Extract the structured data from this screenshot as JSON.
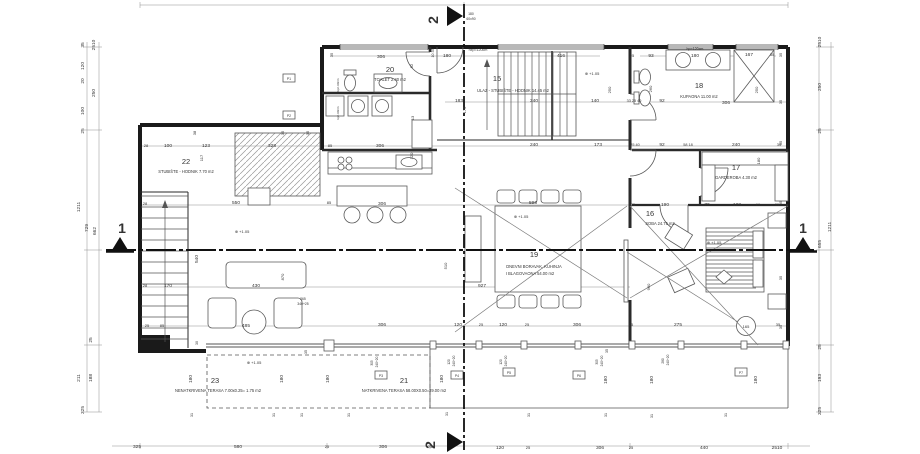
{
  "drawing": {
    "title": "Floor plan - first floor",
    "colors": {
      "wall": "#1a1a1a",
      "line": "#555555",
      "dim": "#8f8f8f",
      "text": "#333333",
      "bg": "#ffffff"
    }
  },
  "rooms": [
    {
      "num": "22",
      "name": "STUBIŠTE - HODNIK 7.70 m2",
      "nx": 186,
      "ny": 164,
      "lx": 186,
      "ly": 173
    },
    {
      "num": "20",
      "name": "TOALET 2.40 m2",
      "nx": 390,
      "ny": 72,
      "lx": 390,
      "ly": 81
    },
    {
      "num": "15",
      "name": "ULAZ - STUBIŠTE - HODNIK 14.45 m2",
      "nx": 497,
      "ny": 81,
      "lx": 513,
      "ly": 92
    },
    {
      "num": "18",
      "name": "KUPAONA 11.00 m2",
      "nx": 699,
      "ny": 88,
      "lx": 699,
      "ly": 98
    },
    {
      "num": "17",
      "name": "GARDEROBA 4.30 m2",
      "nx": 736,
      "ny": 170,
      "lx": 736,
      "ly": 179
    },
    {
      "num": "16",
      "name": "SOBA 24.75 m2",
      "nx": 650,
      "ny": 216,
      "lx": 660,
      "ly": 225
    },
    {
      "num": "19",
      "name": "DNEVNI BORAVAK, KUHINJA",
      "name2": "I BLAGOVAONA 54.00 m2",
      "nx": 534,
      "ny": 257,
      "lx": 534,
      "ly": 268,
      "l2x": 530,
      "l2y": 275
    },
    {
      "num": "23",
      "name": "NENATKRIVENA TERASA 7.00x0.25= 1.75 m2",
      "nx": 215,
      "ny": 383,
      "lx": 218,
      "ly": 392
    },
    {
      "num": "21",
      "name": "NATKRIVENA TERASA 58.00X0.50=29.00 m2",
      "nx": 404,
      "ny": 383,
      "lx": 404,
      "ly": 392
    }
  ],
  "sections": [
    {
      "label": "1",
      "x": 122,
      "y": 233
    },
    {
      "label": "1",
      "x": 803,
      "y": 233
    },
    {
      "label": "2",
      "x": 438,
      "y": 20,
      "r": -90
    },
    {
      "label": "2",
      "x": 435,
      "y": 445,
      "r": -90
    }
  ],
  "dims": [
    {
      "t": "35",
      "x": 84,
      "y": 45,
      "r": -90
    },
    {
      "t": "2510",
      "x": 95,
      "y": 45,
      "r": -90
    },
    {
      "t": "120",
      "x": 84,
      "y": 66,
      "r": -90
    },
    {
      "t": "20",
      "x": 84,
      "y": 81,
      "r": -90
    },
    {
      "t": "250",
      "x": 95,
      "y": 93,
      "r": -90
    },
    {
      "t": "100",
      "x": 84,
      "y": 111,
      "r": -90
    },
    {
      "t": "25",
      "x": 84,
      "y": 131,
      "r": -90
    },
    {
      "t": "1211",
      "x": 80,
      "y": 207,
      "r": -90
    },
    {
      "t": "729",
      "x": 88,
      "y": 228,
      "r": -90
    },
    {
      "t": "662",
      "x": 96,
      "y": 231,
      "r": -90
    },
    {
      "t": "25",
      "x": 92,
      "y": 340,
      "r": -90
    },
    {
      "t": "211",
      "x": 80,
      "y": 378,
      "r": -90
    },
    {
      "t": "188",
      "x": 92,
      "y": 378,
      "r": -90
    },
    {
      "t": "325",
      "x": 84,
      "y": 410,
      "r": -90
    },
    {
      "t": "2510",
      "x": 821,
      "y": 42,
      "r": -90
    },
    {
      "t": "250",
      "x": 821,
      "y": 87,
      "r": -90
    },
    {
      "t": "25",
      "x": 821,
      "y": 131,
      "r": -90
    },
    {
      "t": "1211",
      "x": 831,
      "y": 227,
      "r": -90
    },
    {
      "t": "655",
      "x": 821,
      "y": 244,
      "r": -90
    },
    {
      "t": "25",
      "x": 821,
      "y": 347,
      "r": -90
    },
    {
      "t": "193",
      "x": 821,
      "y": 378,
      "r": -90
    },
    {
      "t": "325",
      "x": 821,
      "y": 411,
      "r": -90
    },
    {
      "t": "35",
      "x": 782,
      "y": 55,
      "r": -90,
      "s": 4
    },
    {
      "t": "35",
      "x": 782,
      "y": 102,
      "r": -90,
      "s": 4
    },
    {
      "t": "35",
      "x": 782,
      "y": 143,
      "r": -90,
      "s": 4
    },
    {
      "t": "35",
      "x": 782,
      "y": 203,
      "r": -90,
      "s": 4
    },
    {
      "t": "35",
      "x": 782,
      "y": 278,
      "r": -90,
      "s": 4
    },
    {
      "t": "35",
      "x": 782,
      "y": 327,
      "r": -90,
      "s": 4
    },
    {
      "t": "306",
      "x": 381,
      "y": 58
    },
    {
      "t": "180",
      "x": 447,
      "y": 57
    },
    {
      "t": "hxp=120cm",
      "x": 478,
      "y": 51,
      "s": 3.6
    },
    {
      "t": "416",
      "x": 561,
      "y": 57
    },
    {
      "t": "25",
      "x": 632,
      "y": 57,
      "s": 4
    },
    {
      "t": "93",
      "x": 651,
      "y": 57
    },
    {
      "t": "180",
      "x": 695,
      "y": 57
    },
    {
      "t": "hp=120cm",
      "x": 695,
      "y": 50,
      "s": 3.6
    },
    {
      "t": "167",
      "x": 749,
      "y": 56
    },
    {
      "t": "35",
      "x": 772,
      "y": 56,
      "s": 4
    },
    {
      "t": "35",
      "x": 333,
      "y": 55,
      "r": -90,
      "s": 4
    },
    {
      "t": "10 35",
      "x": 434,
      "y": 53,
      "r": -90,
      "s": 3.6
    },
    {
      "t": "180",
      "x": 471,
      "y": 15,
      "s": 3.4
    },
    {
      "t": "60x90",
      "x": 471,
      "y": 20,
      "s": 3.4
    },
    {
      "t": "⊕ +1.05",
      "x": 592,
      "y": 75,
      "s": 4
    },
    {
      "t": "250",
      "x": 611,
      "y": 90,
      "r": -90,
      "s": 4
    },
    {
      "t": "260",
      "x": 652,
      "y": 89,
      "r": -90,
      "s": 4
    },
    {
      "t": "250",
      "x": 758,
      "y": 90,
      "r": -90,
      "s": 4
    },
    {
      "t": "92",
      "x": 413,
      "y": 66,
      "r": -90,
      "s": 4
    },
    {
      "t": "183",
      "x": 459,
      "y": 102
    },
    {
      "t": "240",
      "x": 534,
      "y": 102
    },
    {
      "t": "140",
      "x": 595,
      "y": 102
    },
    {
      "t": "33 25 40",
      "x": 634,
      "y": 102,
      "s": 3.8
    },
    {
      "t": "92",
      "x": 662,
      "y": 102
    },
    {
      "t": "306",
      "x": 726,
      "y": 104
    },
    {
      "t": "13",
      "x": 414,
      "y": 118,
      "r": -90,
      "s": 4
    },
    {
      "t": "175",
      "x": 466,
      "y": 110,
      "r": -90,
      "s": 4
    },
    {
      "t": "120",
      "x": 413,
      "y": 156,
      "r": -90,
      "s": 4
    },
    {
      "t": "28",
      "x": 146,
      "y": 147,
      "s": 4
    },
    {
      "t": "100",
      "x": 168,
      "y": 147
    },
    {
      "t": "123",
      "x": 206,
      "y": 147
    },
    {
      "t": "38",
      "x": 196,
      "y": 133,
      "r": -90,
      "s": 4
    },
    {
      "t": "117",
      "x": 203,
      "y": 158,
      "r": -90,
      "s": 4
    },
    {
      "t": "328",
      "x": 272,
      "y": 147
    },
    {
      "t": "35",
      "x": 284,
      "y": 133,
      "r": -90,
      "s": 4
    },
    {
      "t": "35",
      "x": 309,
      "y": 133,
      "r": -90,
      "s": 4
    },
    {
      "t": "85",
      "x": 330,
      "y": 147,
      "s": 4
    },
    {
      "t": "306",
      "x": 380,
      "y": 147
    },
    {
      "t": "240",
      "x": 534,
      "y": 146
    },
    {
      "t": "173",
      "x": 598,
      "y": 146
    },
    {
      "t": "25 40",
      "x": 635,
      "y": 146,
      "s": 3.8
    },
    {
      "t": "92",
      "x": 662,
      "y": 146
    },
    {
      "t": "58 18",
      "x": 688,
      "y": 146,
      "s": 3.8
    },
    {
      "t": "240",
      "x": 736,
      "y": 146
    },
    {
      "t": "35",
      "x": 779,
      "y": 146,
      "s": 4
    },
    {
      "t": "180",
      "x": 760,
      "y": 161,
      "r": -90,
      "s": 4
    },
    {
      "t": "25",
      "x": 633,
      "y": 206,
      "s": 4
    },
    {
      "t": "190",
      "x": 665,
      "y": 206
    },
    {
      "t": "70",
      "x": 707,
      "y": 206
    },
    {
      "t": "128",
      "x": 737,
      "y": 206
    },
    {
      "t": "60",
      "x": 758,
      "y": 206,
      "s": 4
    },
    {
      "t": "35",
      "x": 777,
      "y": 206,
      "s": 4
    },
    {
      "t": "⊕ +1.05",
      "x": 714,
      "y": 244,
      "s": 4
    },
    {
      "t": "540",
      "x": 198,
      "y": 259,
      "r": -90
    },
    {
      "t": "550",
      "x": 236,
      "y": 204
    },
    {
      "t": "85",
      "x": 329,
      "y": 204,
      "s": 4
    },
    {
      "t": "306",
      "x": 382,
      "y": 205
    },
    {
      "t": "596",
      "x": 533,
      "y": 204
    },
    {
      "t": "⊕ +1.05",
      "x": 242,
      "y": 233,
      "s": 4
    },
    {
      "t": "⊕ +1.05",
      "x": 521,
      "y": 218,
      "s": 4
    },
    {
      "t": "28",
      "x": 145,
      "y": 205,
      "s": 4
    },
    {
      "t": "28",
      "x": 145,
      "y": 287,
      "s": 4
    },
    {
      "t": "170",
      "x": 168,
      "y": 287
    },
    {
      "t": "430",
      "x": 256,
      "y": 287
    },
    {
      "t": "870",
      "x": 284,
      "y": 277,
      "r": -90,
      "s": 4
    },
    {
      "t": "510",
      "x": 447,
      "y": 266,
      "r": -90,
      "s": 4
    },
    {
      "t": "927",
      "x": 482,
      "y": 287
    },
    {
      "t": "960",
      "x": 650,
      "y": 287,
      "r": -90,
      "s": 4
    },
    {
      "t": "265",
      "x": 303,
      "y": 300,
      "s": 3.4
    },
    {
      "t": "340+25",
      "x": 303,
      "y": 305,
      "s": 3.4
    },
    {
      "t": "25",
      "x": 147,
      "y": 327,
      "s": 4
    },
    {
      "t": "85",
      "x": 162,
      "y": 327,
      "s": 4
    },
    {
      "t": "485",
      "x": 246,
      "y": 327
    },
    {
      "t": "306",
      "x": 382,
      "y": 326
    },
    {
      "t": "120",
      "x": 458,
      "y": 326
    },
    {
      "t": "25",
      "x": 481,
      "y": 326,
      "s": 4
    },
    {
      "t": "120",
      "x": 503,
      "y": 326
    },
    {
      "t": "25",
      "x": 527,
      "y": 326,
      "s": 4
    },
    {
      "t": "306",
      "x": 577,
      "y": 326
    },
    {
      "t": "25",
      "x": 631,
      "y": 326,
      "s": 4
    },
    {
      "t": "275",
      "x": 678,
      "y": 326
    },
    {
      "t": "165",
      "x": 746,
      "y": 328,
      "s": 4
    },
    {
      "t": "35",
      "x": 778,
      "y": 326,
      "s": 4
    },
    {
      "t": "30",
      "x": 198,
      "y": 343,
      "r": -90,
      "s": 3.6
    },
    {
      "t": "35",
      "x": 307,
      "y": 352,
      "r": -90,
      "s": 3.6
    },
    {
      "t": "35",
      "x": 608,
      "y": 351,
      "r": -90,
      "s": 3.6
    },
    {
      "t": "⊕ +1.05",
      "x": 254,
      "y": 364,
      "s": 4
    },
    {
      "t": "305",
      "x": 373,
      "y": 363,
      "r": -90,
      "s": 3.2
    },
    {
      "t": "240+20",
      "x": 378,
      "y": 362,
      "r": -90,
      "s": 3.2
    },
    {
      "t": "120",
      "x": 450,
      "y": 362,
      "r": -90,
      "s": 3.2
    },
    {
      "t": "240+20",
      "x": 455,
      "y": 361,
      "r": -90,
      "s": 3.2
    },
    {
      "t": "120",
      "x": 502,
      "y": 362,
      "r": -90,
      "s": 3.2
    },
    {
      "t": "240+20",
      "x": 507,
      "y": 361,
      "r": -90,
      "s": 3.2
    },
    {
      "t": "305",
      "x": 598,
      "y": 362,
      "r": -90,
      "s": 3.2
    },
    {
      "t": "240+20",
      "x": 603,
      "y": 361,
      "r": -90,
      "s": 3.2
    },
    {
      "t": "280",
      "x": 664,
      "y": 361,
      "r": -90,
      "s": 3.2
    },
    {
      "t": "240+20",
      "x": 669,
      "y": 360,
      "r": -90,
      "s": 3.2
    },
    {
      "t": "180",
      "x": 192,
      "y": 379,
      "r": -90
    },
    {
      "t": "180",
      "x": 283,
      "y": 379,
      "r": -90
    },
    {
      "t": "180",
      "x": 329,
      "y": 379,
      "r": -90
    },
    {
      "t": "180",
      "x": 443,
      "y": 379,
      "r": -90
    },
    {
      "t": "180",
      "x": 607,
      "y": 380,
      "r": -90
    },
    {
      "t": "180",
      "x": 653,
      "y": 380,
      "r": -90
    },
    {
      "t": "180",
      "x": 757,
      "y": 380,
      "r": -90
    },
    {
      "t": "31",
      "x": 193,
      "y": 415,
      "r": -90,
      "s": 3.6
    },
    {
      "t": "31",
      "x": 275,
      "y": 415,
      "r": -90,
      "s": 3.6
    },
    {
      "t": "31",
      "x": 303,
      "y": 415,
      "r": -90,
      "s": 3.6
    },
    {
      "t": "31",
      "x": 350,
      "y": 415,
      "r": -90,
      "s": 3.6
    },
    {
      "t": "31",
      "x": 448,
      "y": 414,
      "r": -90,
      "s": 3.6
    },
    {
      "t": "31",
      "x": 530,
      "y": 415,
      "r": -90,
      "s": 3.6
    },
    {
      "t": "31",
      "x": 607,
      "y": 415,
      "r": -90,
      "s": 3.6
    },
    {
      "t": "31",
      "x": 653,
      "y": 416,
      "r": -90,
      "s": 3.6
    },
    {
      "t": "31",
      "x": 727,
      "y": 415,
      "r": -90,
      "s": 3.6
    },
    {
      "t": "325",
      "x": 137,
      "y": 448
    },
    {
      "t": "580",
      "x": 238,
      "y": 448
    },
    {
      "t": "25",
      "x": 327,
      "y": 448,
      "s": 4
    },
    {
      "t": "306",
      "x": 383,
      "y": 448
    },
    {
      "t": "25",
      "x": 430,
      "y": 448,
      "s": 4
    },
    {
      "t": "120",
      "x": 500,
      "y": 449
    },
    {
      "t": "25",
      "x": 528,
      "y": 449,
      "s": 4
    },
    {
      "t": "306",
      "x": 600,
      "y": 449
    },
    {
      "t": "25",
      "x": 631,
      "y": 449,
      "s": 4
    },
    {
      "t": "440",
      "x": 704,
      "y": 449
    },
    {
      "t": "2510",
      "x": 777,
      "y": 449
    },
    {
      "t": "P1",
      "x": 289,
      "y": 80,
      "s": 3.4
    },
    {
      "t": "P2",
      "x": 289,
      "y": 117,
      "s": 3.4
    },
    {
      "t": "P3",
      "x": 381,
      "y": 377,
      "s": 3.4
    },
    {
      "t": "P4",
      "x": 457,
      "y": 377,
      "s": 3.4
    },
    {
      "t": "P5",
      "x": 509,
      "y": 374,
      "s": 3.4
    },
    {
      "t": "P6",
      "x": 579,
      "y": 377,
      "s": 3.4
    },
    {
      "t": "P7",
      "x": 741,
      "y": 374,
      "s": 3.4
    },
    {
      "t": "kpn 90cm",
      "x": 339,
      "y": 85,
      "r": -90,
      "s": 3
    },
    {
      "t": "kpn 90cm",
      "x": 339,
      "y": 113,
      "r": -90,
      "s": 3
    }
  ]
}
